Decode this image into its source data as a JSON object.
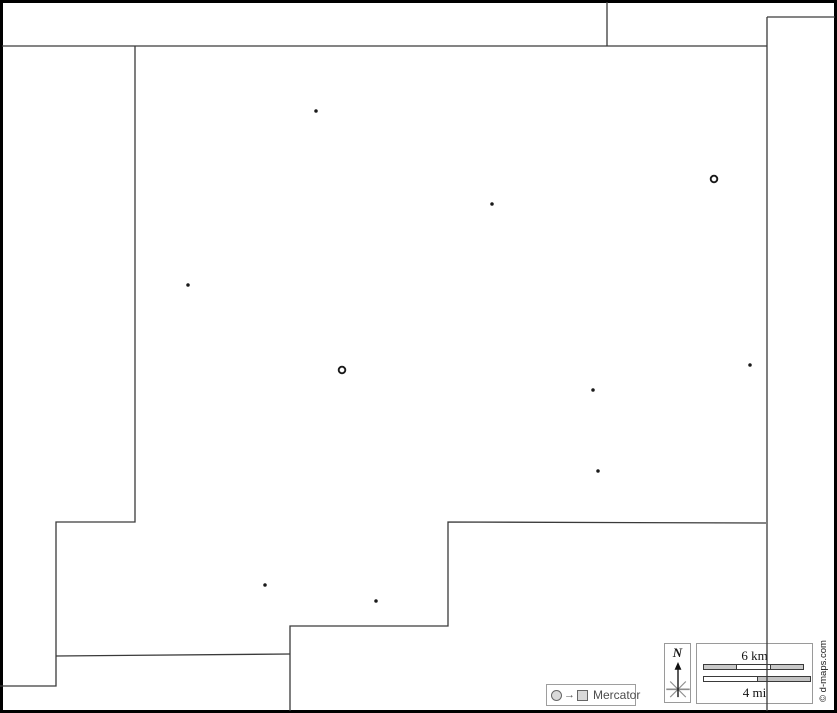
{
  "map": {
    "width": 837,
    "height": 713,
    "background_color": "#ffffff",
    "frame_color": "#000000",
    "frame_width": 3,
    "line_color": "#3a3a3a",
    "line_width": 1.3,
    "boundaries": [
      [
        [
          607,
          2
        ],
        [
          607,
          46
        ]
      ],
      [
        [
          2,
          46
        ],
        [
          767,
          46
        ]
      ],
      [
        [
          767,
          17
        ],
        [
          835,
          17
        ]
      ],
      [
        [
          767,
          17
        ],
        [
          767,
          711
        ]
      ],
      [
        [
          135,
          46
        ],
        [
          135,
          522
        ],
        [
          56,
          522
        ],
        [
          56,
          686
        ],
        [
          0,
          686
        ]
      ],
      [
        [
          56,
          656
        ],
        [
          290,
          654
        ]
      ],
      [
        [
          290,
          711
        ],
        [
          290,
          626
        ],
        [
          448,
          626
        ],
        [
          448,
          522
        ],
        [
          766,
          523
        ]
      ]
    ],
    "town_color": "#1a1a1a",
    "town_radius": 1.75,
    "admin_radius": 3.3,
    "admin_stroke_width": 1.9,
    "towns": [
      {
        "x": 316,
        "y": 111
      },
      {
        "x": 492,
        "y": 204
      },
      {
        "x": 188,
        "y": 285
      },
      {
        "x": 750,
        "y": 365
      },
      {
        "x": 593,
        "y": 390
      },
      {
        "x": 598,
        "y": 471
      },
      {
        "x": 265,
        "y": 585
      },
      {
        "x": 376,
        "y": 601
      }
    ],
    "admin_centers": [
      {
        "x": 714,
        "y": 179
      },
      {
        "x": 342,
        "y": 370
      }
    ]
  },
  "north": {
    "label": "N"
  },
  "scale": {
    "km_label": "6 km",
    "mi_label": "4 mi",
    "km_bar_segments": [
      "#c9c9c9",
      "#ffffff",
      "#c9c9c9"
    ],
    "mi_bar_segments": [
      "#ffffff",
      "#c2c2c2"
    ]
  },
  "legend": {
    "projection_label": "Mercator",
    "arrow_glyph": "→"
  },
  "copyright": {
    "text": "© d-maps.com"
  }
}
